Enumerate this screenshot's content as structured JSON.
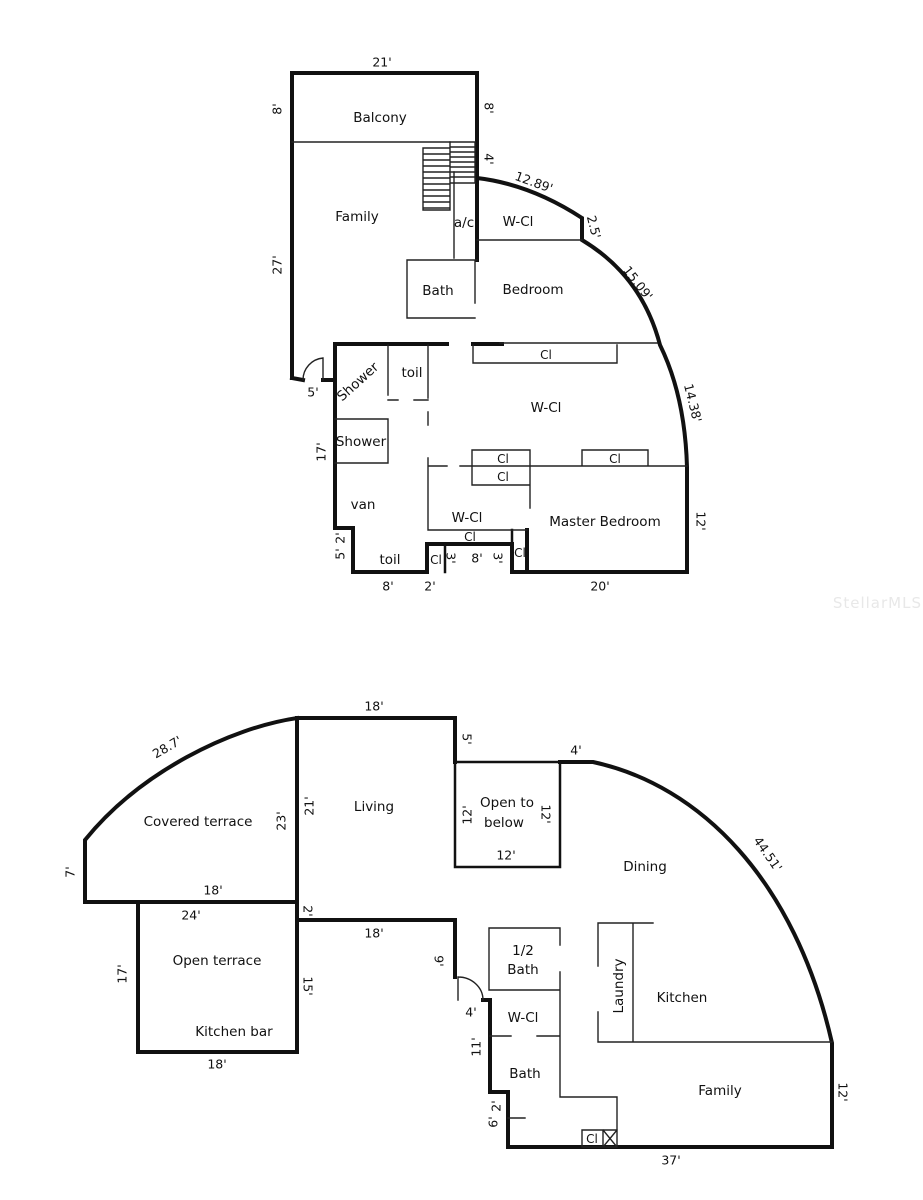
{
  "watermark": "StellarMLS",
  "upper_floor": {
    "rooms": {
      "balcony": "Balcony",
      "family": "Family",
      "ac": "a/c",
      "wcl_top": "W-Cl",
      "bath": "Bath",
      "bedroom": "Bedroom",
      "shower_a": "Shower",
      "toil_a": "toil",
      "shower_b": "Shower",
      "van": "van",
      "wcl_mid": "W-Cl",
      "wcl_low": "W-Cl",
      "master": "Master Bedroom",
      "toil_b": "toil"
    },
    "closet": "Cl",
    "dims": {
      "balcony_width": "21'",
      "balcony_left": "8'",
      "balcony_right": "8'",
      "family_left": "27'",
      "stair_right": "4'",
      "curve_a": "12.89'",
      "wall_step": "2.5'",
      "curve_b": "15.09'",
      "curve_c": "14.38'",
      "master_right": "12'",
      "master_bottom": "20'",
      "entry_door": "5'",
      "shower_left": "17'",
      "step_top": "2'",
      "step_side": "5'",
      "toil_bottom": "8'",
      "notch_bottom": "2'",
      "notch_left": "3'",
      "notch_mid": "8'",
      "notch_right": "3'"
    }
  },
  "lower_floor": {
    "rooms": {
      "covered_terrace": "Covered terrace",
      "living": "Living",
      "open_below_1": "Open to",
      "open_below_2": "below",
      "dining": "Dining",
      "open_terrace": "Open terrace",
      "kitchen_bar": "Kitchen bar",
      "half_bath_1": "1/2",
      "half_bath_2": "Bath",
      "wcl": "W-Cl",
      "bath": "Bath",
      "laundry": "Laundry",
      "kitchen": "Kitchen",
      "family": "Family"
    },
    "closet": "Cl",
    "dims": {
      "living_top": "18'",
      "terrace_curve": "28.7'",
      "living_right": "5'",
      "dining_top": "4'",
      "dining_curve": "44.51'",
      "terrace_left": "7'",
      "terrace_bottom": "18'",
      "open_terrace_top": "24'",
      "jog": "2'",
      "hall_top": "18'",
      "living_left_outer": "23'",
      "living_left_inner": "21'",
      "otb_left": "12'",
      "otb_right": "12'",
      "otb_bottom": "12'",
      "open_terrace_left": "17'",
      "open_terrace_right": "15'",
      "hall_right": "9'",
      "open_terrace_bottom": "18'",
      "entry_door": "4'",
      "bath_left": "11'",
      "step_side": "6'",
      "step_top": "2'",
      "family_bottom": "37'",
      "family_right": "12'"
    }
  }
}
